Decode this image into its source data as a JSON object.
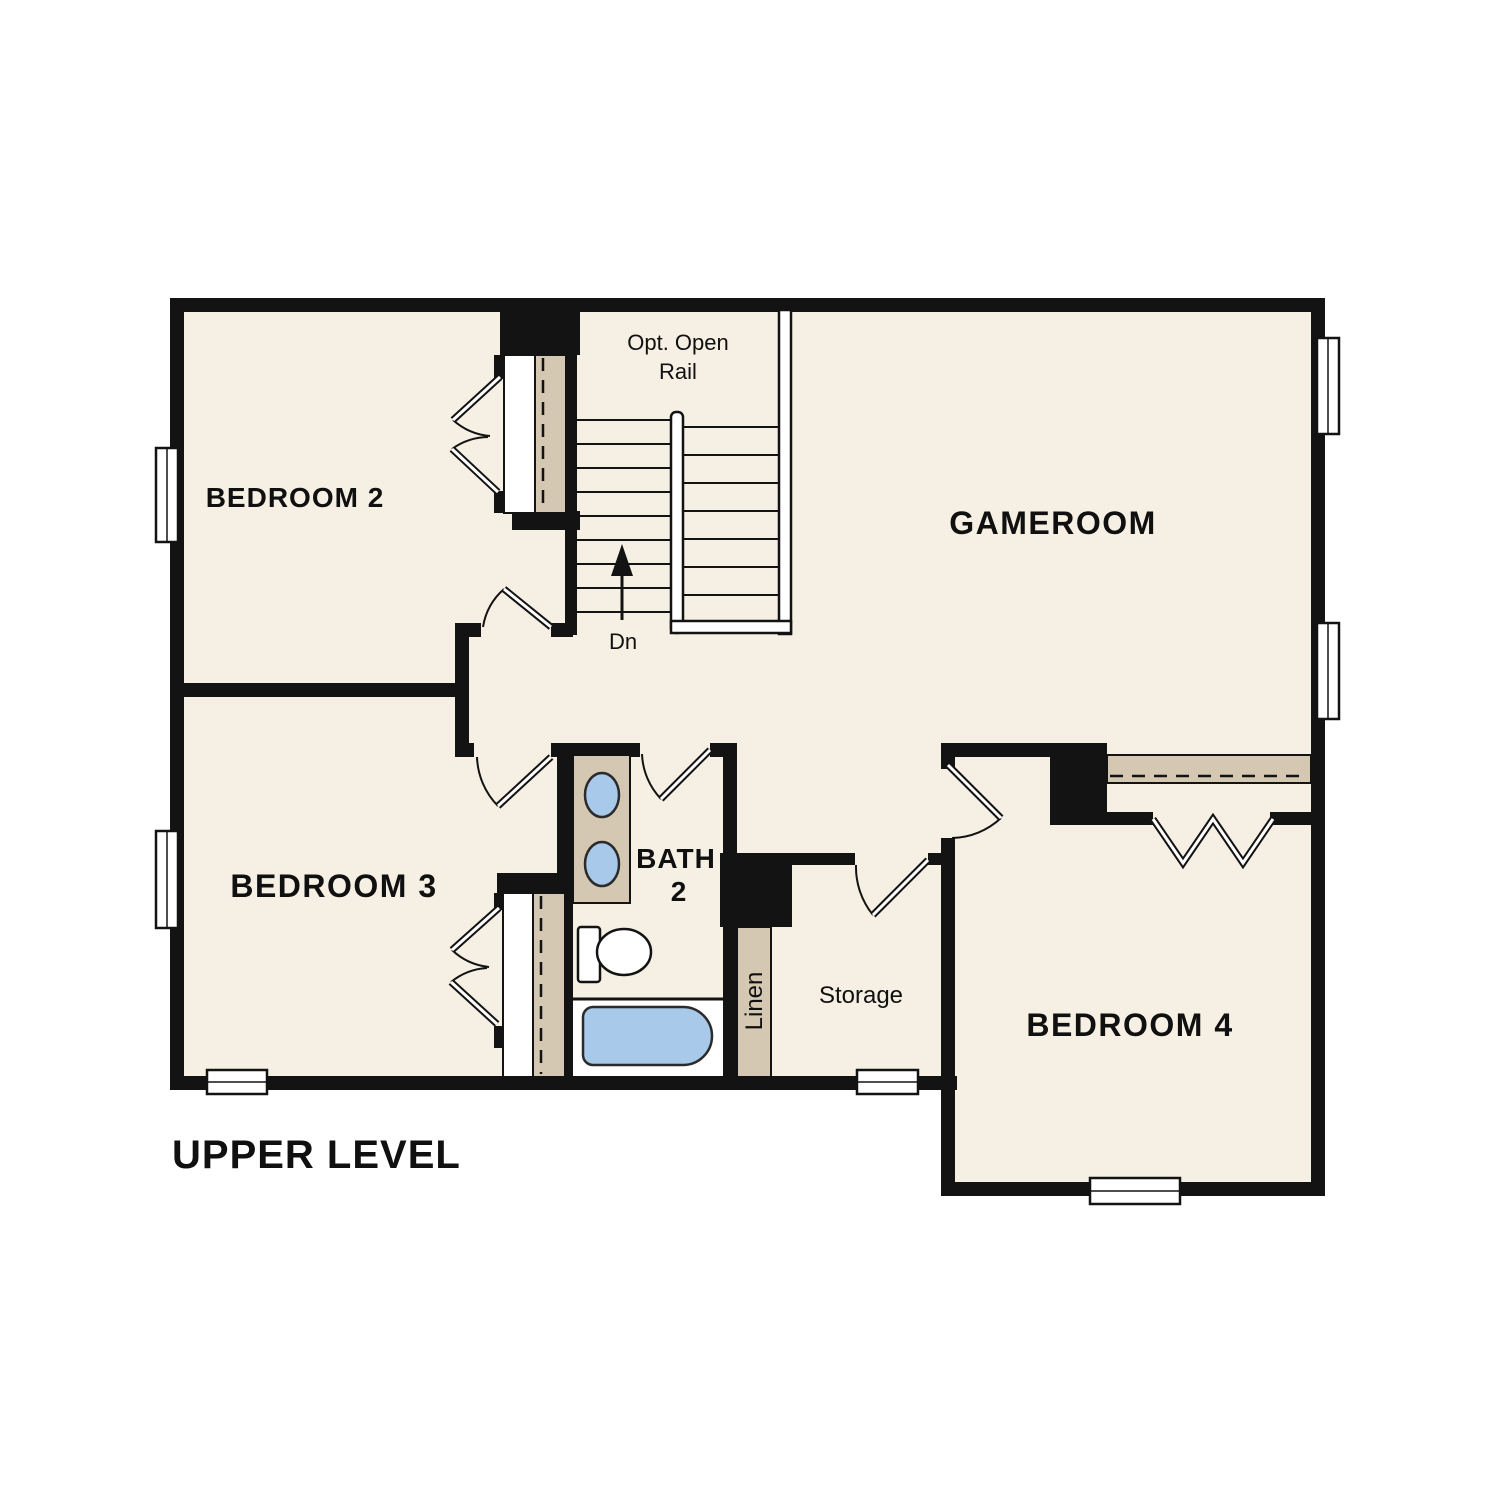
{
  "floorplan": {
    "level_title": "UPPER LEVEL",
    "rooms": {
      "bedroom2": {
        "label": "BEDROOM 2"
      },
      "bedroom3": {
        "label": "BEDROOM 3"
      },
      "bedroom4": {
        "label": "BEDROOM 4"
      },
      "gameroom": {
        "label": "GAMEROOM"
      },
      "bath2": {
        "label_line1": "BATH",
        "label_line2": "2"
      },
      "storage": {
        "label": "Storage"
      },
      "linen": {
        "label": "Linen"
      }
    },
    "stairs": {
      "note_line1": "Opt. Open",
      "note_line2": "Rail",
      "down_label": "Dn"
    },
    "colors": {
      "background": "#ffffff",
      "floor": "#f6efe3",
      "wall": "#131313",
      "closet_shelf": "#d5c8b2",
      "fixture_blue": "#a8c9e9",
      "outline": "#131313"
    }
  }
}
